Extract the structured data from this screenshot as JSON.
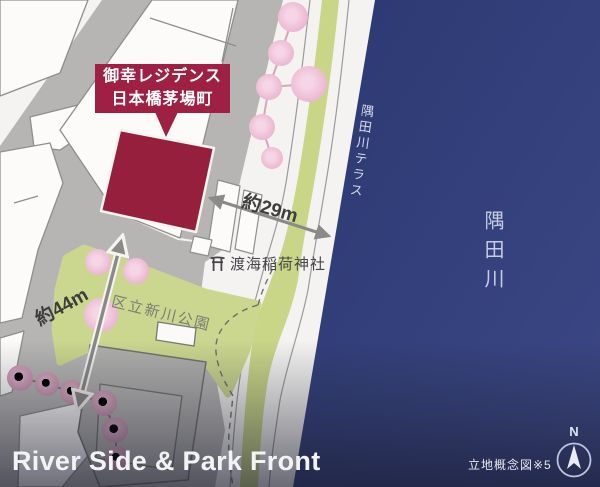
{
  "labels": {
    "property": {
      "line1": "御幸レジデンス",
      "line2": "日本橋茅場町"
    },
    "distance_29m": "約29m",
    "distance_44m": "約44m",
    "shrine": "渡海稲荷神社",
    "park": "区立新川公園",
    "terrace": "隅田川テラス",
    "river": "隅田川",
    "compass_north": "N"
  },
  "footer": {
    "headline": "River Side & Park Front",
    "caption": "立地概念図※5"
  },
  "colors": {
    "site_red": "#951f3c",
    "label_red": "#9e2143",
    "river_blue": "#2e3b77",
    "street_gray": "#b6b5b3",
    "park_green": "#cbd78e",
    "bank_green": "#c9d687",
    "tree_pink": "#f0c4da",
    "tree_mauve": "#d0a0b9",
    "arrow_gray": "#8a8a88",
    "headline_white": "#f3f3f5"
  }
}
